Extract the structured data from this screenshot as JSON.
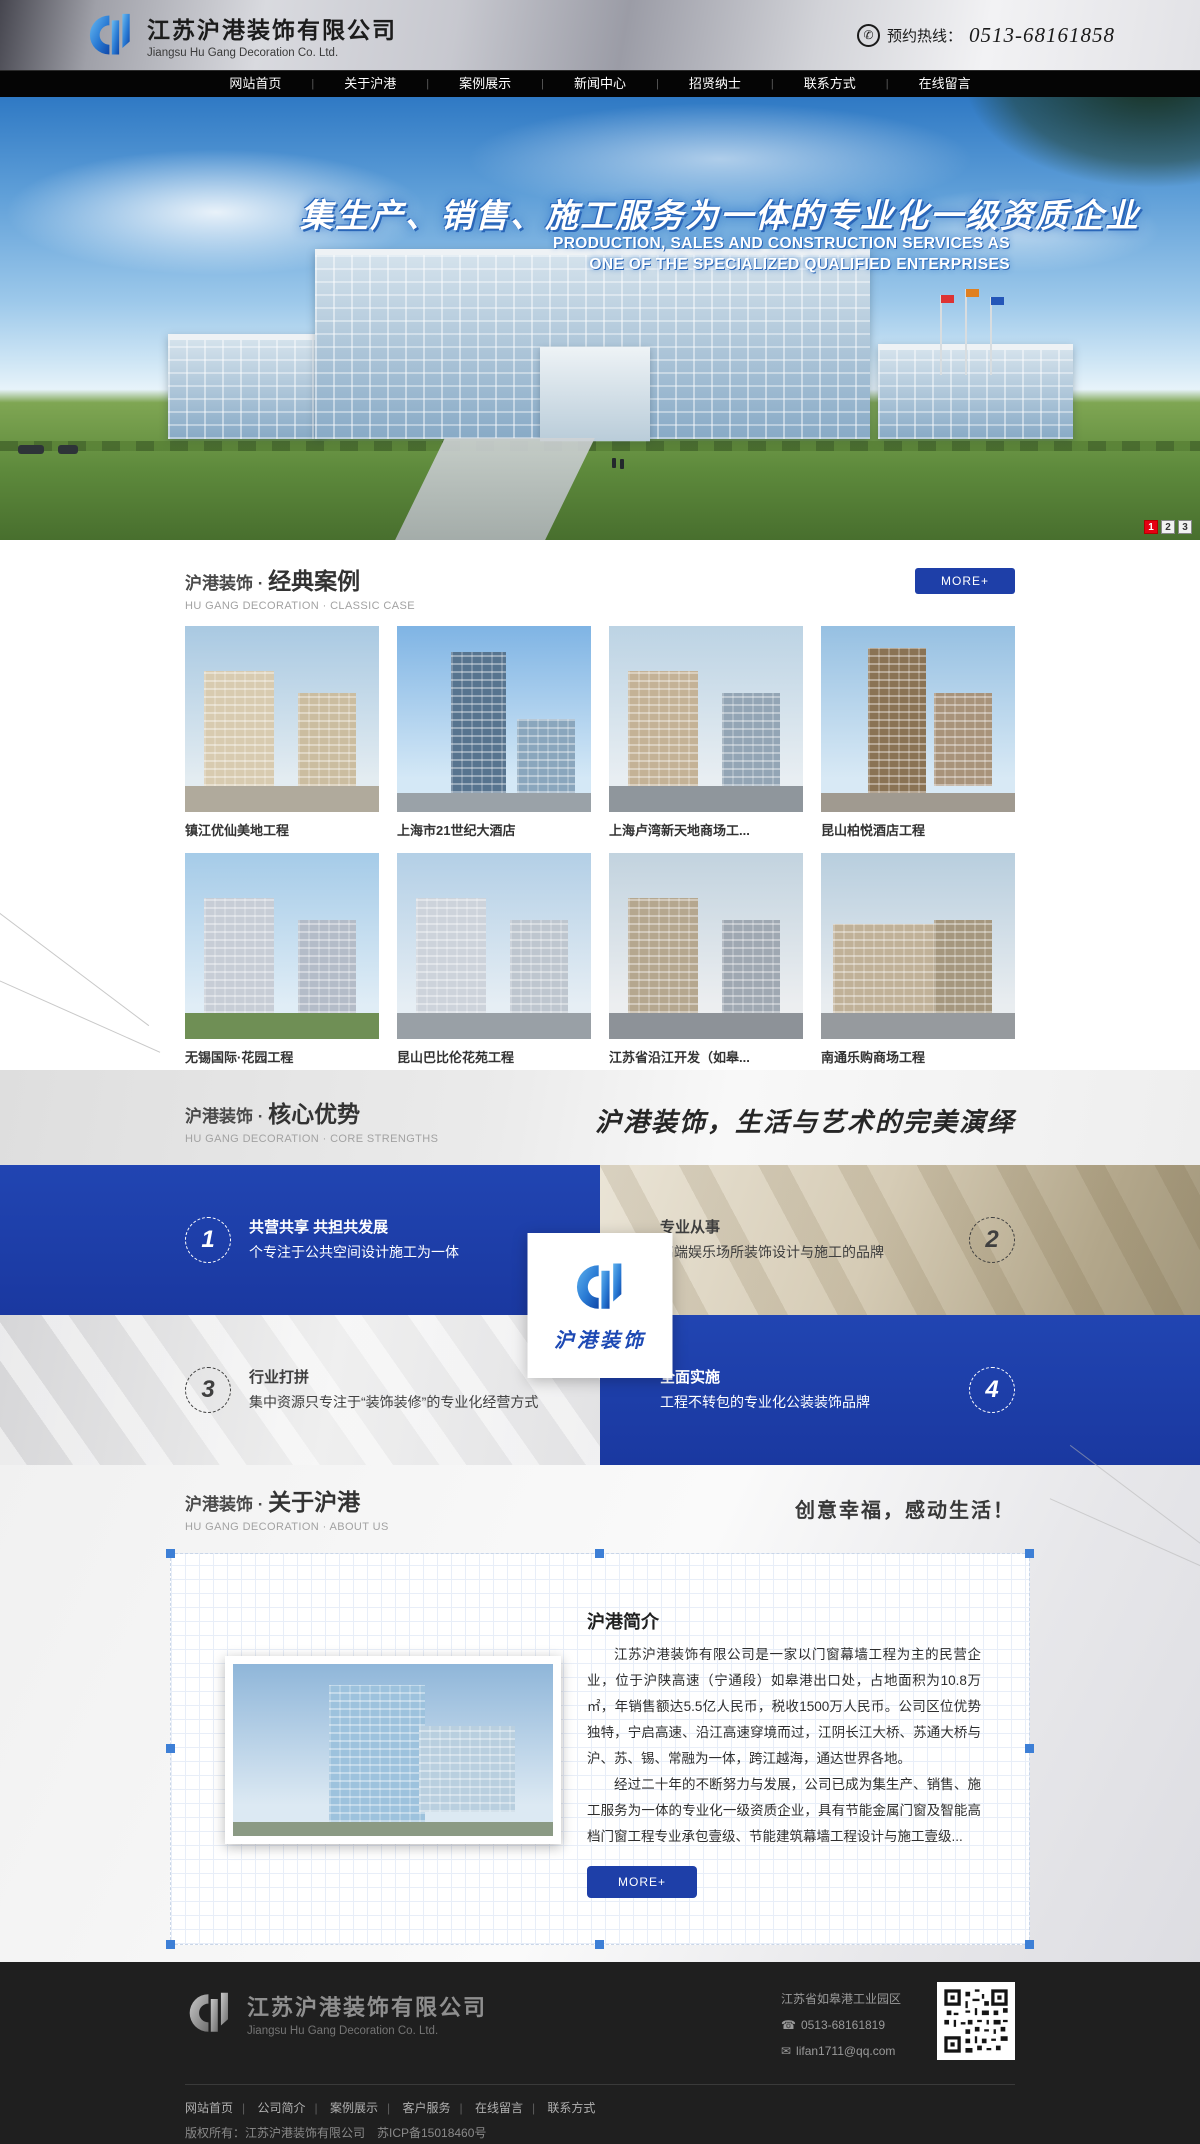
{
  "colors": {
    "accent_blue": "#1e3fa8",
    "band_blue": "#1c3aa6",
    "active_red": "#e60012",
    "footer_bg": "#1f1f1f"
  },
  "icons": {
    "phone_circle": "✆",
    "phone": "☎",
    "mail": "✉"
  },
  "header": {
    "company_name_cn": "江苏沪港装饰有限公司",
    "company_name_en": "Jiangsu Hu Gang Decoration Co. Ltd.",
    "hotline_label": "预约热线：",
    "hotline_number": "0513-68161858"
  },
  "nav": {
    "separator": "|",
    "items": [
      "网站首页",
      "关于沪港",
      "案例展示",
      "新闻中心",
      "招贤纳士",
      "联系方式",
      "在线留言"
    ]
  },
  "banner": {
    "slogan_cn": "集生产、销售、施工服务为一体的专业化一级资质企业",
    "slogan_en_line1": "PRODUCTION, SALES AND CONSTRUCTION SERVICES AS",
    "slogan_en_line2": "ONE OF THE SPECIALIZED QUALIFIED ENTERPRISES",
    "pagination": [
      "1",
      "2",
      "3"
    ]
  },
  "cases": {
    "title_prefix": "沪港装饰 · ",
    "title_main": "经典案例",
    "subtitle": "HU GANG DECORATION · CLASSIC CASE",
    "more_label": "MORE+",
    "items": [
      {
        "caption": "镇江优仙美地工程"
      },
      {
        "caption": "上海市21世纪大酒店"
      },
      {
        "caption": "上海卢湾新天地商场工..."
      },
      {
        "caption": "昆山柏悦酒店工程"
      },
      {
        "caption": "无锡国际·花园工程"
      },
      {
        "caption": "昆山巴比伦花苑工程"
      },
      {
        "caption": "江苏省沿江开发（如皋..."
      },
      {
        "caption": "南通乐购商场工程"
      }
    ]
  },
  "strengths": {
    "title_prefix": "沪港装饰 · ",
    "title_main": "核心优势",
    "subtitle": "HU GANG DECORATION · CORE STRENGTHS",
    "calligraphy": "沪港装饰，生活与艺术的完美演绎",
    "logo_card_text": "沪港装饰",
    "items": [
      {
        "num": "1",
        "title": "共营共享 共担共发展",
        "desc": "个专注于公共空间设计施工为一体"
      },
      {
        "num": "2",
        "title": "专业从事",
        "desc": "高端娱乐场所装饰设计与施工的品牌"
      },
      {
        "num": "3",
        "title": "行业打拼",
        "desc": "集中资源只专注于“装饰装修”的专业化经营方式"
      },
      {
        "num": "4",
        "title": "全面实施",
        "desc": "工程不转包的专业化公装装饰品牌"
      }
    ]
  },
  "about": {
    "title_prefix": "沪港装饰 · ",
    "title_main": "关于沪港",
    "subtitle": "HU GANG DECORATION · ABOUT US",
    "slogan": "创意幸福，感动生活！",
    "heading": "沪港简介",
    "para1": "江苏沪港装饰有限公司是一家以门窗幕墙工程为主的民营企业，位于沪陕高速（宁通段）如皋港出口处，占地面积为10.8万㎡，年销售额达5.5亿人民币，税收1500万人民币。公司区位优势独特，宁启高速、沿江高速穿境而过，江阴长江大桥、苏通大桥与沪、苏、锡、常融为一体，跨江越海，通达世界各地。",
    "para2": "经过二十年的不断努力与发展，公司已成为集生产、销售、施工服务为一体的专业化一级资质企业，具有节能金属门窗及智能高档门窗工程专业承包壹级、节能建筑幕墙工程设计与施工壹级...",
    "more_label": "MORE+"
  },
  "footer": {
    "company_name_cn": "江苏沪港装饰有限公司",
    "company_name_en": "Jiangsu Hu Gang Decoration Co. Ltd.",
    "address": "江苏省如皋港工业园区",
    "phone": "0513-68161819",
    "email": "lifan1711@qq.com",
    "separator": "|",
    "links": [
      "网站首页",
      "公司简介",
      "案例展示",
      "客户服务",
      "在线留言",
      "联系方式"
    ],
    "copyright": "版权所有：江苏沪港装饰有限公司　苏ICP备15018460号"
  }
}
